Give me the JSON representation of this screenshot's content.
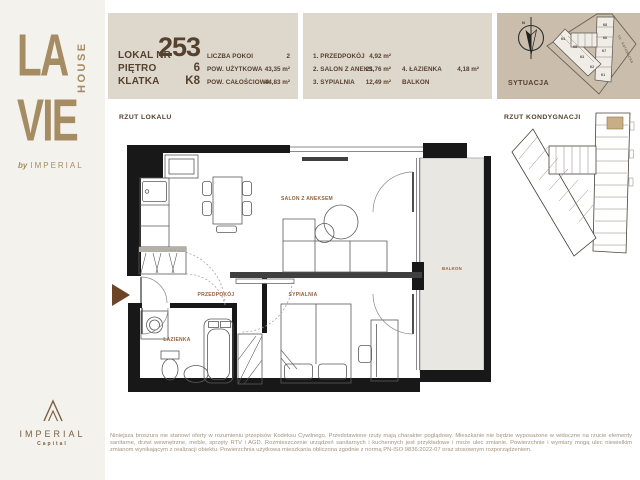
{
  "brand": {
    "logo_la": "LA",
    "logo_vie": "VIE",
    "logo_house": "HOUSE",
    "logo_by_prefix": "by",
    "logo_by_name": "IMPERIAL",
    "footer_name": "IMPERIAL",
    "footer_sub": "Capital",
    "colors": {
      "gold": "#a68c63",
      "dark_brown": "#54412e",
      "rust_label": "#96603a",
      "header_box": "#ded7cc",
      "situation_box": "#cabdab",
      "left_panel": "#f4f2ed",
      "balcony_fill": "#e9e7e2",
      "highlight_unit": "#c8ad85"
    }
  },
  "header": {
    "lokal_label": "LOKAL NR",
    "lokal_value": "253",
    "pietro_label": "PIĘTRO",
    "pietro_value": "6",
    "klatka_label": "KLATKA",
    "klatka_value": "K8",
    "stats": [
      {
        "label": "LICZBA POKOI",
        "value": "2"
      },
      {
        "label": "POW. UŻYTKOWA",
        "value": "43,35 m²"
      },
      {
        "label": "POW. CAŁOŚCIOWA",
        "value": "44,83 m²"
      }
    ],
    "rooms_col1": [
      {
        "name": "1. PRZEDPOKÓJ",
        "area": "4,92 m²"
      },
      {
        "name": "2. SALON Z ANEKS.",
        "area": "21,76 m²"
      },
      {
        "name": "3. SYPIALNIA",
        "area": "12,49 m²"
      }
    ],
    "rooms_col2": [
      {
        "name": "4. ŁAZIENKA",
        "area": "4,18 m²"
      },
      {
        "name": "BALKON",
        "area": ""
      }
    ]
  },
  "sections": {
    "plan_title": "RZUT LOKALU",
    "situation_title": "SYTUACJA",
    "storey_title": "RZUT KONDYGNACJI"
  },
  "floor_plan": {
    "salon": "SALON Z ANEKSEM",
    "przedpokoj": "PRZEDPOKÓJ",
    "sypialnia": "SYPIALNIA",
    "lazienka": "ŁAZIENKA",
    "balkon": "BALKON"
  },
  "site_plan": {
    "street": "UL. KATOWICKA",
    "klatki": [
      "K8",
      "K6",
      "K7",
      "K1",
      "K5",
      "K4",
      "K3",
      "K2"
    ]
  },
  "compass": {
    "north": "N"
  },
  "footer": {
    "disclaimer": "Niniejsza broszura nie stanowi oferty w rozumieniu przepisów Kodeksu Cywilnego. Przedstawione rzuty mają charakter poglądowy. Mieszkanie nie będzie wyposażone w widoczne na rzucie elementy sanitarne, drzwi wewnętrzne, meble, sprzęty RTV i AGD. Rozmieszczenie urządzeń sanitarnych i kuchennych jest przykładowe i może ulec zmianie. Powierzchnie i wymiary mogą ulec niewielkim zmianom wynikającym z realizacji obiektu. Powierzchnia użytkowa mieszkania obliczona zgodnie z normą PN-ISO 9836:2022-07 oraz stosownym rozporządzeniem."
  }
}
